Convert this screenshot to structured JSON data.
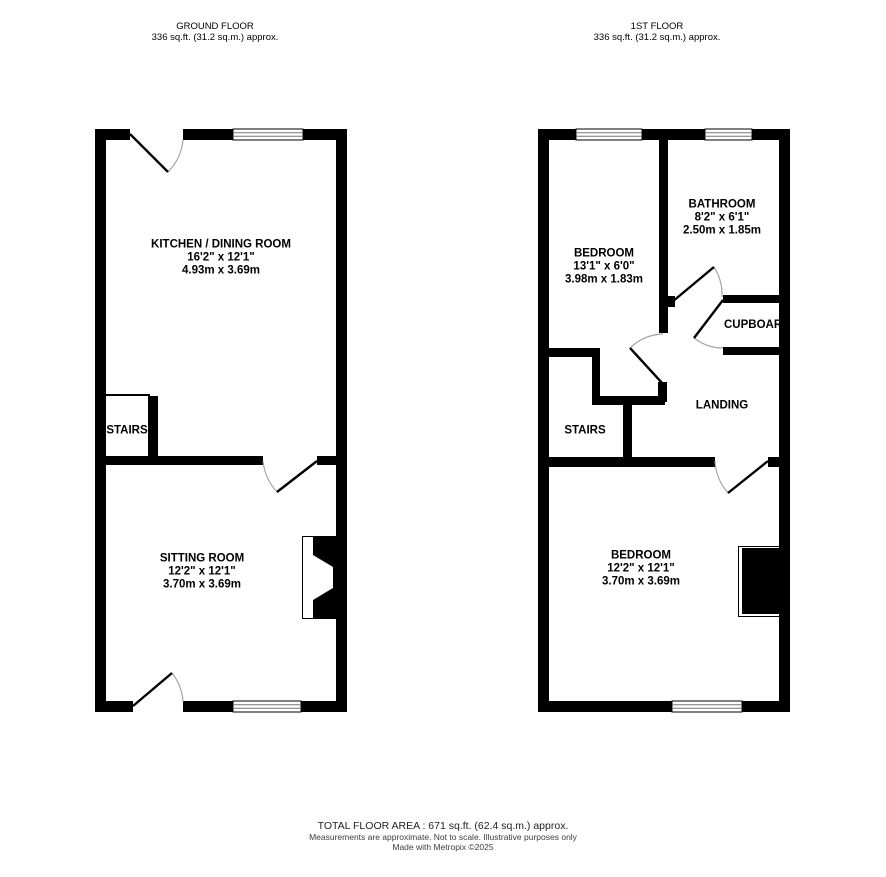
{
  "ground_floor": {
    "title": "GROUND FLOOR",
    "area": "336 sq.ft. (31.2 sq.m.) approx.",
    "rooms": {
      "kitchen": {
        "name": "KITCHEN / DINING ROOM",
        "imperial": "16'2\" x 12'1\"",
        "metric": "4.93m x 3.69m"
      },
      "sitting": {
        "name": "SITTING ROOM",
        "imperial": "12'2\" x 12'1\"",
        "metric": "3.70m x 3.69m"
      },
      "stairs": {
        "name": "STAIRS"
      }
    }
  },
  "first_floor": {
    "title": "1ST FLOOR",
    "area": "336 sq.ft. (31.2 sq.m.) approx.",
    "rooms": {
      "bedroom_front": {
        "name": "BEDROOM",
        "imperial": "13'1\" x 6'0\"",
        "metric": "3.98m x 1.83m"
      },
      "bathroom": {
        "name": "BATHROOM",
        "imperial": "8'2\" x 6'1\"",
        "metric": "2.50m x 1.85m"
      },
      "cupboard": {
        "name": "CUPBOARD"
      },
      "landing": {
        "name": "LANDING"
      },
      "stairs": {
        "name": "STAIRS"
      },
      "bedroom_back": {
        "name": "BEDROOM",
        "imperial": "12'2\" x 12'1\"",
        "metric": "3.70m x 3.69m"
      }
    }
  },
  "footer": {
    "total": "TOTAL FLOOR AREA : 671 sq.ft. (62.4 sq.m.) approx.",
    "disclaimer": "Measurements are approximate.  Not to scale.  Illustrative purposes only",
    "credit": "Made with Metropix ©2025"
  },
  "colors": {
    "wall": "#000000",
    "background": "#ffffff",
    "door_arc": "#a3a3a3",
    "window_line": "#777777"
  }
}
